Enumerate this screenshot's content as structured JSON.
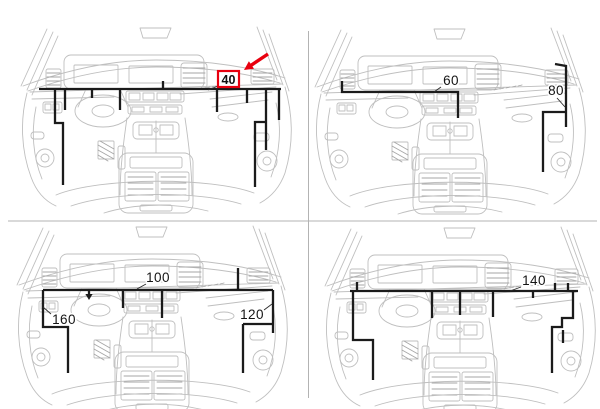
{
  "figure": {
    "type": "vehicle-dashboard-harness-location-diagram",
    "panels_count": 4,
    "selected_value": "40"
  },
  "colors": {
    "highlight_red": "#e8000f",
    "harness_black": "#1b1b1b",
    "sketch_gray": "#bfbfbf",
    "sketch_gray_dark": "#a6a6a6",
    "divider_gray": "#b3b3b3",
    "background": "#ffffff"
  },
  "dividers": {
    "vertical": {
      "x": 308.5,
      "y1": 31,
      "y2": 398
    },
    "horizontal": {
      "y": 221,
      "x1": 8,
      "x2": 597
    }
  },
  "sketch_offsets": [
    [
      14,
      25
    ],
    [
      308,
      26
    ],
    [
      10,
      224
    ],
    [
      318,
      225
    ]
  ],
  "panels": [
    {
      "name": "panel-top-left",
      "highlight": {
        "label": "40",
        "box": {
          "x": 218,
          "y": 71,
          "w": 21,
          "h": 16
        },
        "leader": [
          [
            218,
            86
          ],
          [
            208,
            90
          ]
        ],
        "arrow": {
          "tail": [
            268,
            54
          ],
          "tip": [
            244,
            70
          ]
        }
      },
      "labels": [],
      "harness": [
        [
          [
            39,
            89
          ],
          [
            281,
            89
          ]
        ],
        [
          [
            163,
            81
          ],
          [
            163,
            89
          ]
        ],
        [
          [
            55,
            89
          ],
          [
            55,
            123
          ],
          [
            63,
            123
          ],
          [
            63,
            185
          ]
        ],
        [
          [
            65,
            89
          ],
          [
            65,
            110
          ]
        ],
        [
          [
            92,
            89
          ],
          [
            92,
            98
          ]
        ],
        [
          [
            120,
            89
          ],
          [
            120,
            110
          ]
        ],
        [
          [
            217,
            89
          ],
          [
            217,
            112
          ]
        ],
        [
          [
            247,
            89
          ],
          [
            247,
            103
          ]
        ],
        [
          [
            266,
            89
          ],
          [
            266,
            150
          ]
        ],
        [
          [
            266,
            122
          ],
          [
            255,
            122
          ],
          [
            255,
            187
          ]
        ],
        [
          [
            279,
            89
          ],
          [
            279,
            120
          ]
        ]
      ],
      "down_arrows": []
    },
    {
      "name": "panel-top-right",
      "highlight": null,
      "labels": [
        {
          "text": "60",
          "x": 451,
          "y": 85,
          "leader": [
            [
              441,
              87
            ],
            [
              434,
              92
            ]
          ]
        },
        {
          "text": "80",
          "x": 556,
          "y": 95,
          "leader": [
            [
              557,
              98
            ],
            [
              565,
              107
            ]
          ]
        }
      ],
      "harness": [
        [
          [
            342,
            81
          ],
          [
            342,
            92
          ],
          [
            458,
            92
          ],
          [
            458,
            118
          ]
        ],
        [
          [
            555,
            64
          ],
          [
            566,
            66
          ],
          [
            566,
            127
          ]
        ],
        [
          [
            566,
            112
          ],
          [
            543,
            112
          ],
          [
            543,
            172
          ]
        ]
      ],
      "down_arrows": []
    },
    {
      "name": "panel-bottom-left",
      "highlight": null,
      "labels": [
        {
          "text": "100",
          "x": 158,
          "y": 282,
          "leader": [
            [
              146,
              284
            ],
            [
              137,
              289
            ]
          ]
        },
        {
          "text": "160",
          "x": 64,
          "y": 324,
          "leader": [
            [
              51,
              314
            ],
            [
              43,
              307
            ]
          ]
        },
        {
          "text": "120",
          "x": 252,
          "y": 319,
          "leader": [
            [
              264,
              310
            ],
            [
              272,
              304
            ]
          ]
        }
      ],
      "harness": [
        [
          [
            43,
            290
          ],
          [
            273,
            290
          ]
        ],
        [
          [
            43,
            290
          ],
          [
            43,
            327
          ],
          [
            68,
            327
          ],
          [
            68,
            373
          ]
        ],
        [
          [
            89,
            290
          ],
          [
            89,
            294
          ]
        ],
        [
          [
            123,
            290
          ],
          [
            123,
            308
          ]
        ],
        [
          [
            162,
            290
          ],
          [
            162,
            318
          ]
        ],
        [
          [
            238,
            268
          ],
          [
            238,
            290
          ]
        ],
        [
          [
            273,
            290
          ],
          [
            273,
            333
          ]
        ],
        [
          [
            243,
            324
          ],
          [
            273,
            324
          ]
        ],
        [
          [
            243,
            324
          ],
          [
            243,
            373
          ]
        ]
      ],
      "down_arrows": [
        [
          89,
          294
        ]
      ]
    },
    {
      "name": "panel-bottom-right",
      "highlight": null,
      "labels": [
        {
          "text": "140",
          "x": 534,
          "y": 285,
          "leader": [
            [
              521,
              287
            ],
            [
              510,
              291
            ]
          ]
        }
      ],
      "harness": [
        [
          [
            350,
            291
          ],
          [
            578,
            291
          ]
        ],
        [
          [
            357,
            282
          ],
          [
            357,
            291
          ]
        ],
        [
          [
            353,
            291
          ],
          [
            353,
            340
          ],
          [
            373,
            340
          ],
          [
            373,
            380
          ]
        ],
        [
          [
            432,
            291
          ],
          [
            432,
            318
          ]
        ],
        [
          [
            460,
            291
          ],
          [
            460,
            315
          ]
        ],
        [
          [
            493,
            291
          ],
          [
            493,
            317
          ]
        ],
        [
          [
            533,
            291
          ],
          [
            533,
            298
          ]
        ],
        [
          [
            555,
            283
          ],
          [
            555,
            291
          ]
        ],
        [
          [
            568,
            283
          ],
          [
            568,
            291
          ]
        ],
        [
          [
            573,
            291
          ],
          [
            573,
            318
          ],
          [
            562,
            318
          ],
          [
            562,
            327
          ],
          [
            552,
            327
          ],
          [
            552,
            373
          ]
        ],
        [
          [
            563,
            330
          ],
          [
            563,
            343
          ]
        ]
      ],
      "down_arrows": []
    }
  ]
}
